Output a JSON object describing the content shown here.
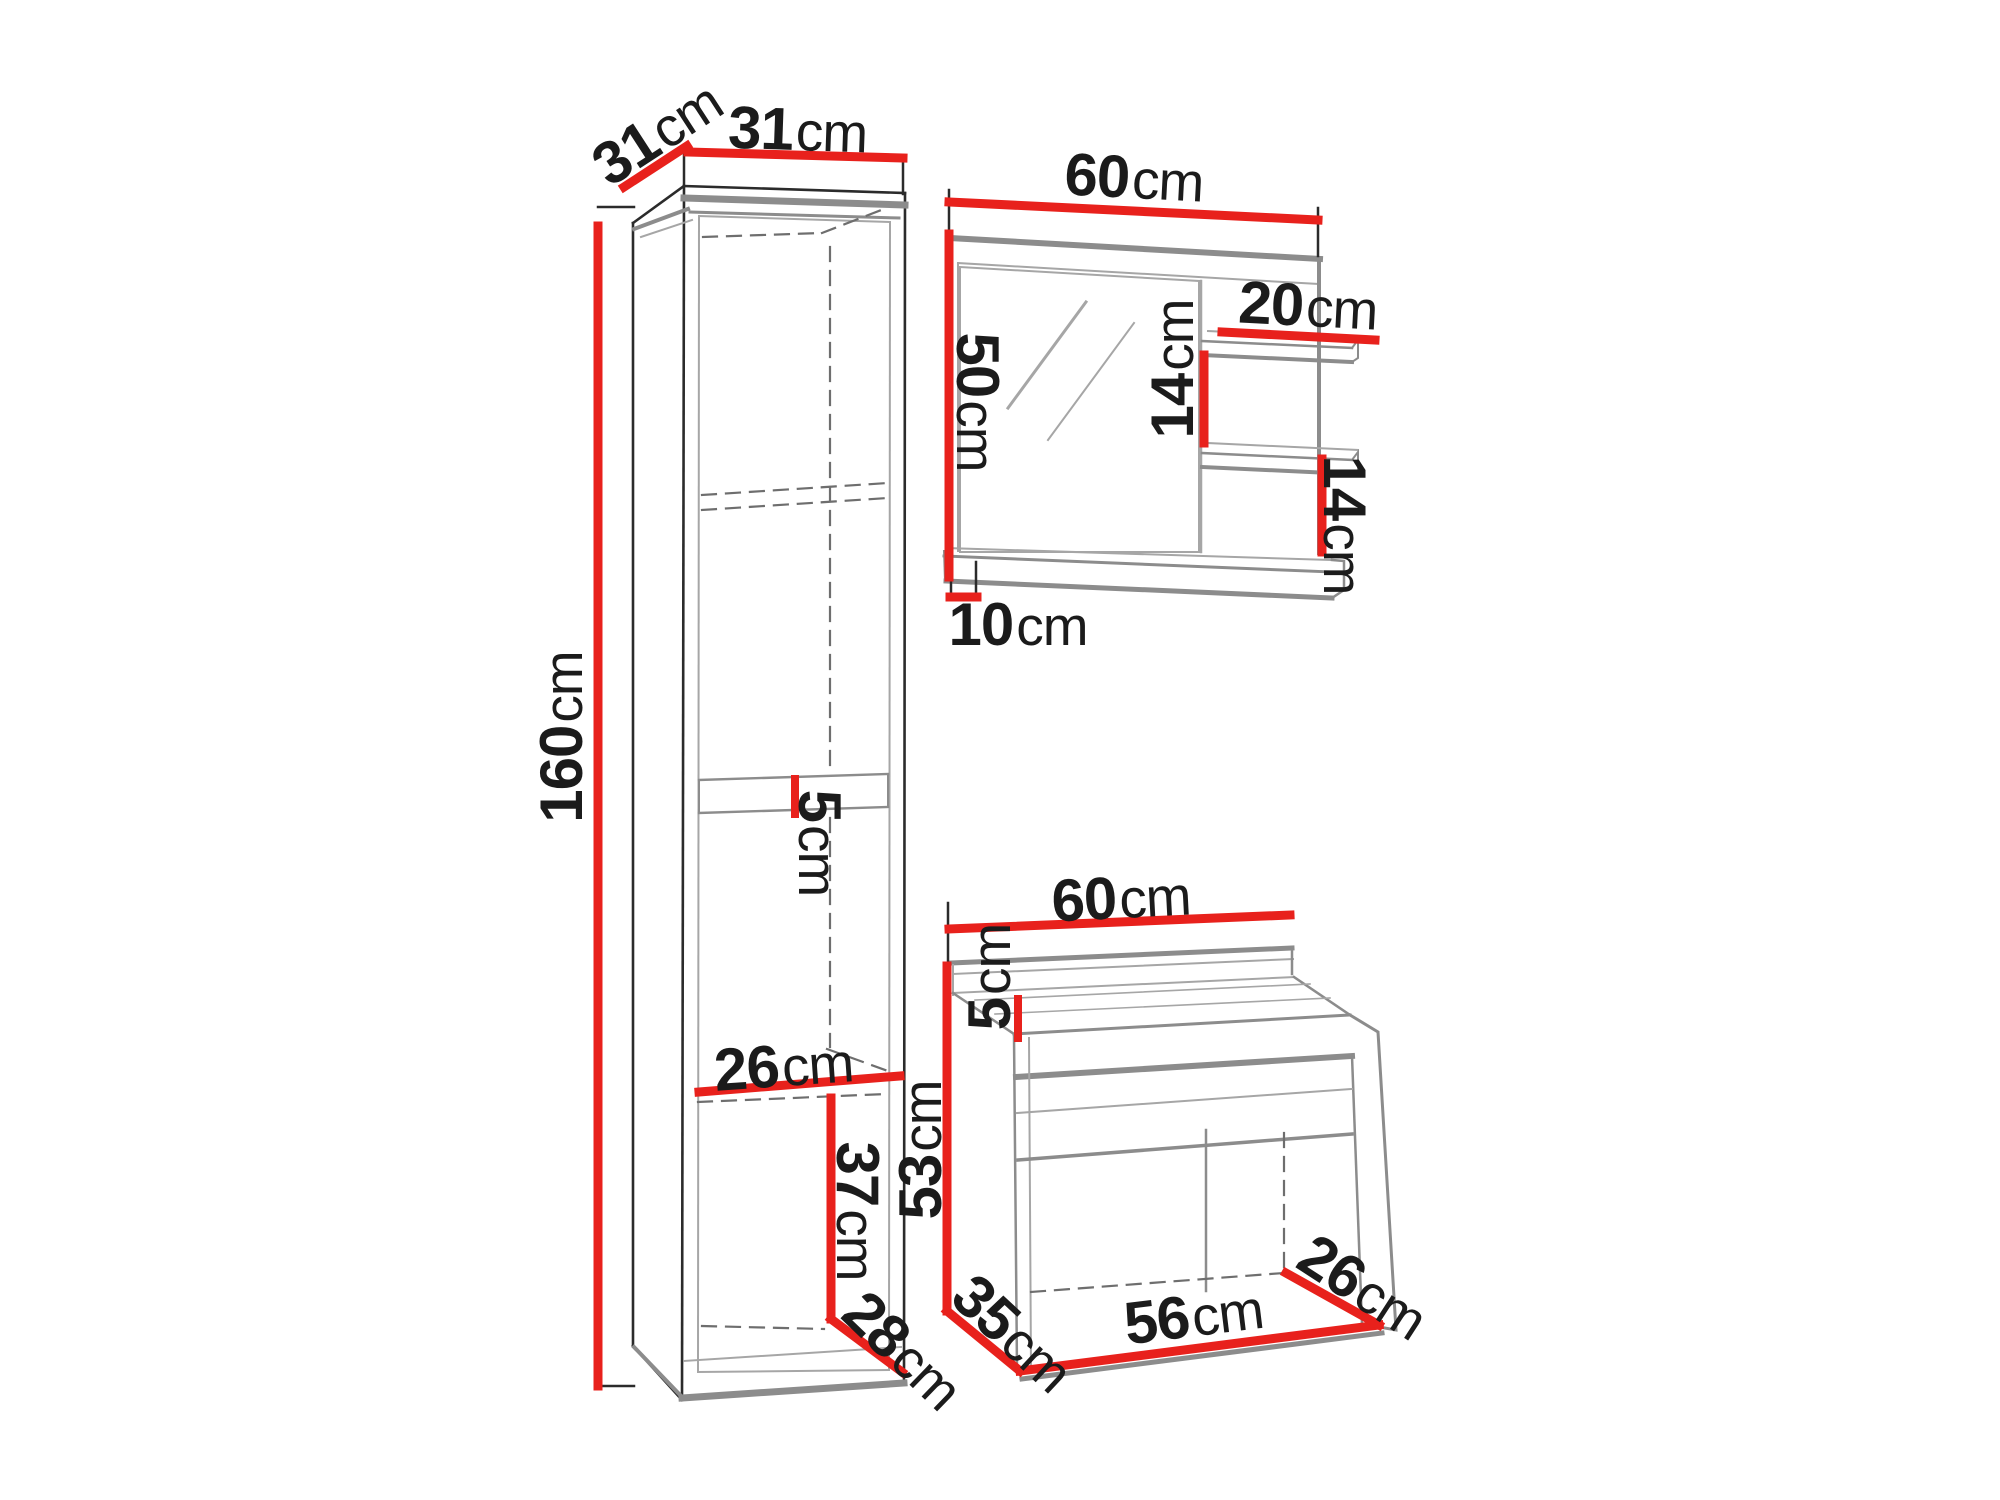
{
  "colors": {
    "dimension_red": "#e8211c",
    "line_gray": "#8c8c8c",
    "line_dark": "#2b2b2b",
    "line_light": "#a6a6a6",
    "dash_gray": "#6e6e6e",
    "text_dark": "#1b1b1b",
    "background": "#ffffff"
  },
  "tall_cabinet": {
    "depth_top": {
      "value": "31",
      "unit": "cm"
    },
    "width_top": {
      "value": "31",
      "unit": "cm"
    },
    "height": {
      "value": "160",
      "unit": "cm"
    },
    "shelf_thickness": {
      "value": "5",
      "unit": "cm"
    },
    "shelf_depth": {
      "value": "26",
      "unit": "cm"
    },
    "lower_section_height": {
      "value": "37",
      "unit": "cm"
    },
    "base_depth": {
      "value": "28",
      "unit": "cm"
    }
  },
  "mirror_cabinet": {
    "width": {
      "value": "60",
      "unit": "cm"
    },
    "height": {
      "value": "50",
      "unit": "cm"
    },
    "shelf_width": {
      "value": "20",
      "unit": "cm"
    },
    "shelf_spacing": {
      "value": "14",
      "unit": "cm"
    },
    "lower_shelf_height": {
      "value": "14",
      "unit": "cm"
    },
    "ledge_depth": {
      "value": "10",
      "unit": "cm"
    }
  },
  "washbasin_cabinet": {
    "width": {
      "value": "60",
      "unit": "cm"
    },
    "top_height": {
      "value": "5",
      "unit": "cm"
    },
    "height": {
      "value": "53",
      "unit": "cm"
    },
    "depth": {
      "value": "35",
      "unit": "cm"
    },
    "inner_width": {
      "value": "56",
      "unit": "cm"
    },
    "inner_depth": {
      "value": "26",
      "unit": "cm"
    }
  }
}
